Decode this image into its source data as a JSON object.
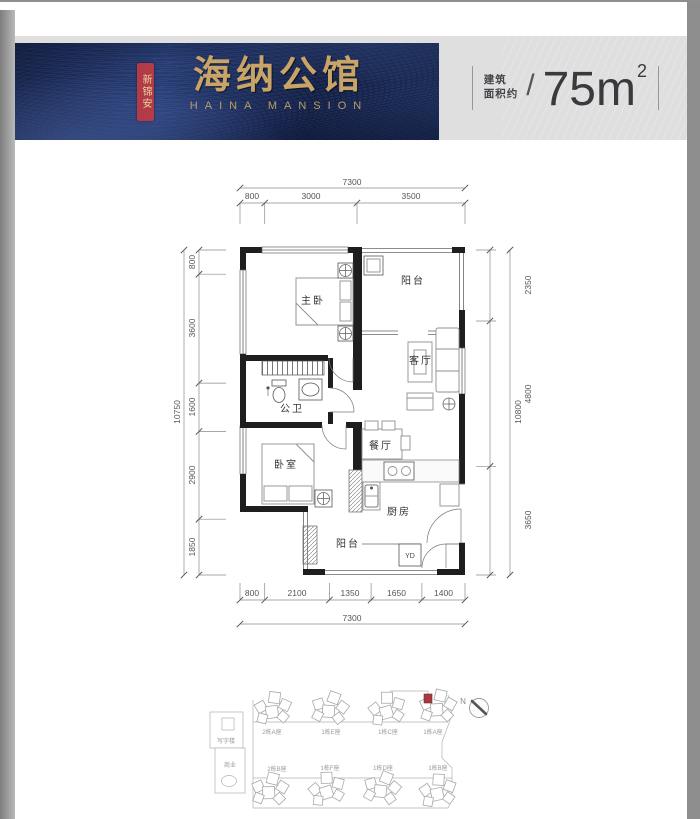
{
  "header": {
    "seal_text": "新锦安",
    "brand_cn": "海纳公馆",
    "brand_en": "HAINA MANSION",
    "area_label_line1": "建筑",
    "area_label_line2": "面积约",
    "area_slash": "/",
    "area_value": "75m",
    "area_sup": "2"
  },
  "colors": {
    "banner_navy": "#1d2c55",
    "brand_gold": "#c9a468",
    "seal_red": "#b23b47",
    "panel_gray": "#dfdfe0",
    "highlight_red": "#a8393f"
  },
  "plan": {
    "rooms": {
      "master": "主卧",
      "balcony_top": "阳台",
      "living": "客厅",
      "bath": "公卫",
      "bedroom": "卧室",
      "dining": "餐厅",
      "kitchen": "厨房",
      "balcony_bottom": "阳台",
      "duct": "YD"
    },
    "dims": {
      "top_total": "7300",
      "top_segments": [
        "800",
        "3000",
        "3500"
      ],
      "bottom_segments": [
        "800",
        "2100",
        "1350",
        "1650",
        "1400"
      ],
      "bottom_total": "7300",
      "left_total": "10750",
      "left_segments": [
        "800",
        "3600",
        "1600",
        "2900",
        "1850"
      ],
      "right_total": "10800",
      "right_segments": [
        "2350",
        "4800",
        "3650"
      ]
    }
  },
  "siteplan": {
    "north_label": "N",
    "office_label": "写字楼",
    "commerce_label": "商业",
    "top_row": [
      "2栋A座",
      "1栋E座",
      "1栋C座",
      "1栋A座"
    ],
    "bottom_row": [
      "2栋B座",
      "1栋F座",
      "1栋D座",
      "1栋B座"
    ]
  }
}
